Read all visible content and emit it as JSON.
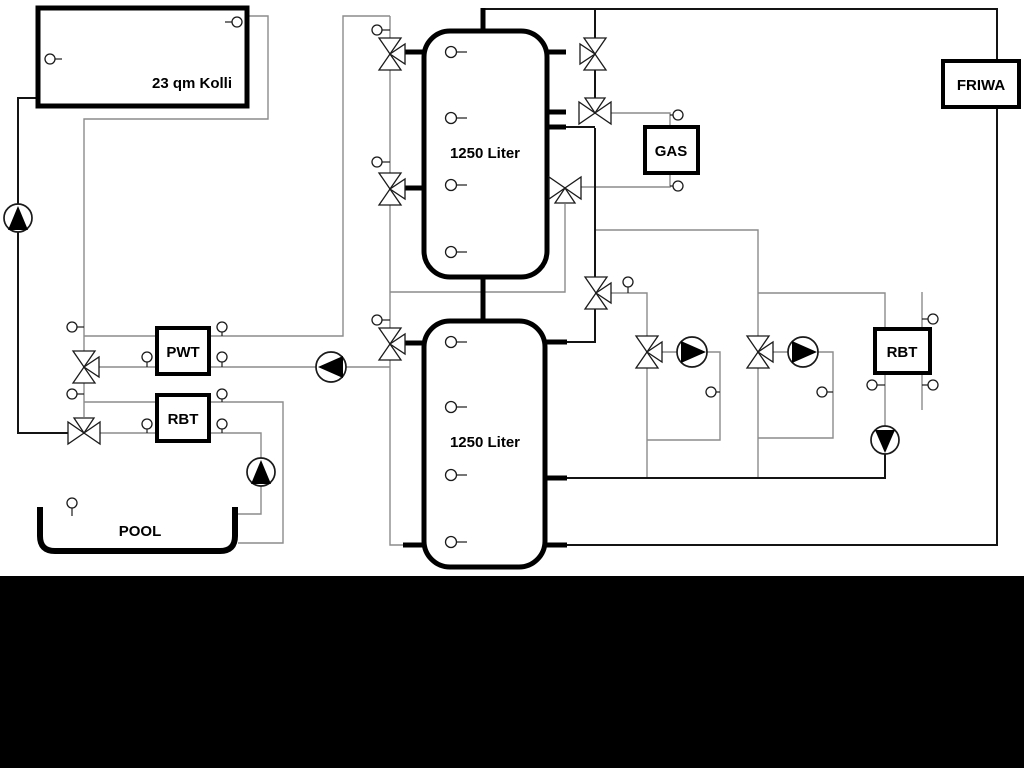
{
  "diagram": {
    "type": "heating-system-hydraulic-schematic",
    "labels": {
      "collector": "23 qm Kolli",
      "tank_top": "1250 Liter",
      "tank_bottom": "1250 Liter",
      "pwt": "PWT",
      "rbt_left": "RBT",
      "gas": "GAS",
      "friwa": "FRIWA",
      "rbt_right": "RBT",
      "pool": "POOL"
    },
    "colors": {
      "background": "#ffffff",
      "line_gray": "#8b8b8b",
      "line_dark": "#141414",
      "component": "#000000",
      "band": "#000000"
    }
  }
}
